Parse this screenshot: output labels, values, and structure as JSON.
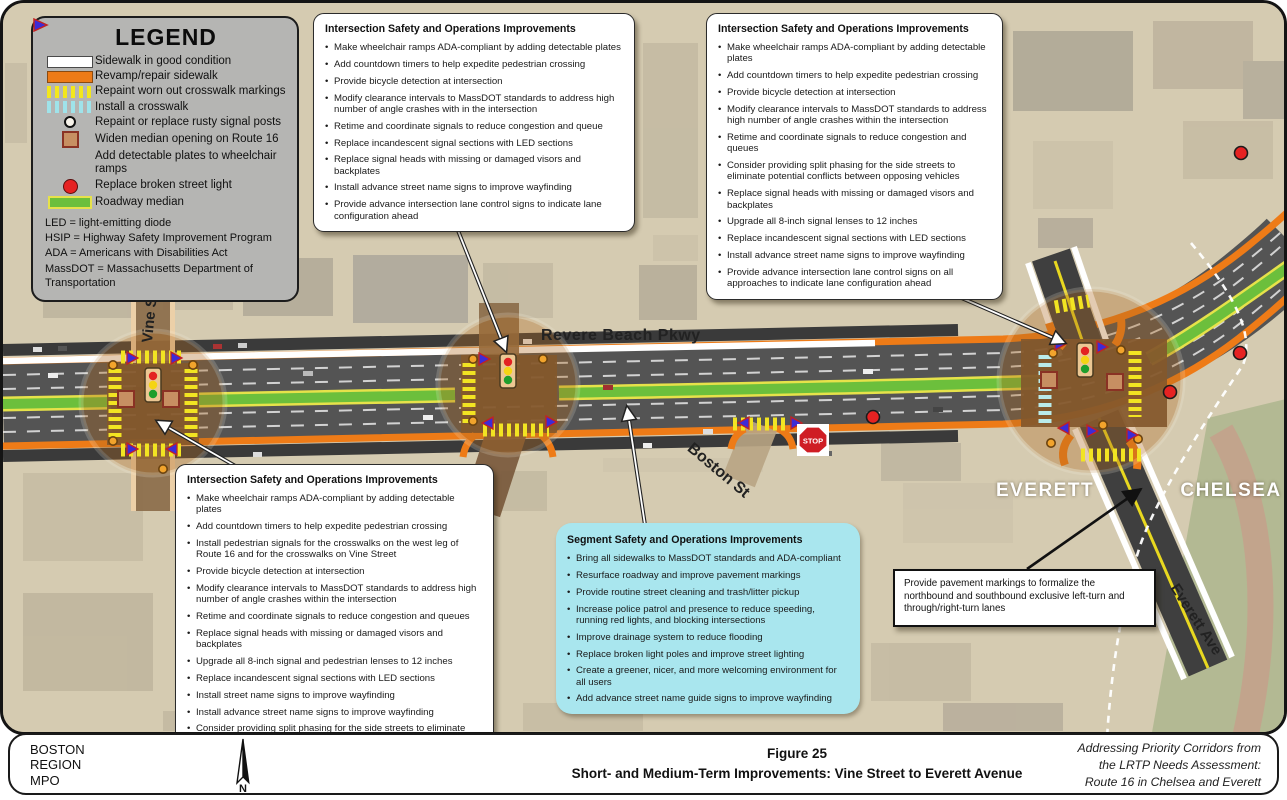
{
  "legend": {
    "title": "LEGEND",
    "items": [
      {
        "name": "sidewalk-good",
        "label": "Sidewalk in good condition"
      },
      {
        "name": "revamp-sidewalk",
        "label": "Revamp/repair sidewalk"
      },
      {
        "name": "repaint-crosswalk",
        "label": "Repaint worn out crosswalk markings"
      },
      {
        "name": "install-crosswalk",
        "label": "Install a crosswalk"
      },
      {
        "name": "rusty-signal-posts",
        "label": "Repaint or replace rusty signal posts"
      },
      {
        "name": "widen-median",
        "label": "Widen median opening on Route 16"
      },
      {
        "name": "detectable-plates",
        "label": "Add detectable plates to wheelchair ramps"
      },
      {
        "name": "broken-street-light",
        "label": "Replace broken street light"
      },
      {
        "name": "roadway-median",
        "label": "Roadway median"
      }
    ],
    "abbreviations": [
      "LED = light-emitting diode",
      "HSIP = Highway Safety Improvement Program",
      "ADA = Americans with Disabilities Act",
      "MassDOT = Massachusetts Department of Transportation"
    ]
  },
  "callouts": {
    "vale": {
      "title": "Intersection Safety and Operations Improvements",
      "bullets": [
        "Make wheelchair ramps ADA-compliant by adding detectable plates",
        "Add countdown timers to help expedite pedestrian crossing",
        "Provide bicycle detection at intersection",
        "Modify clearance intervals to MassDOT standards to address high number of angle crashes with in the intersection",
        "Retime and coordinate signals to reduce congestion and queue",
        "Replace incandescent signal sections with LED sections",
        "Replace signal heads with missing or damaged visors and backplates",
        "Install advance street name signs to improve wayfinding",
        "Provide advance intersection lane control signs to indicate lane configuration ahead"
      ]
    },
    "everett": {
      "title": "Intersection Safety and Operations Improvements",
      "bullets": [
        "Make wheelchair ramps ADA-compliant by adding detectable plates",
        "Add countdown timers to help expedite pedestrian crossing",
        "Provide bicycle detection at intersection",
        "Modify clearance intervals to MassDOT standards to address high number of angle crashes within the intersection",
        "Retime and coordinate signals to reduce congestion and queues",
        "Consider providing split phasing for the side streets to eliminate potential conflicts between opposing vehicles",
        "Replace signal heads with missing or damaged visors and backplates",
        "Upgrade all 8-inch signal lenses to 12 inches",
        "Replace incandescent signal sections with LED sections",
        "Install advance street name signs to improve wayfinding",
        "Provide advance intersection lane control signs on all approaches to indicate lane configuration ahead"
      ]
    },
    "vine": {
      "title": "Intersection Safety and Operations Improvements",
      "bullets": [
        "Make wheelchair ramps ADA-compliant by adding detectable plates",
        "Add countdown timers to help expedite pedestrian crossing",
        "Install pedestrian signals for the crosswalks on the west leg of Route 16 and for the crosswalks on Vine Street",
        "Provide bicycle detection at intersection",
        "Modify clearance intervals to MassDOT standards to address high number of angle crashes within the intersection",
        "Retime and coordinate signals to reduce congestion and queues",
        "Replace signal heads with missing or damaged visors and backplates",
        "Upgrade all 8-inch signal and pedestrian lenses to 12 inches",
        "Replace incandescent signal sections with LED sections",
        "Install street name signs to improve wayfinding",
        "Install advance street name signs to improve wayfinding",
        "Consider providing split phasing for the side streets to eliminate conflicts"
      ]
    },
    "segment": {
      "title": "Segment Safety and Operations Improvements",
      "bullets": [
        "Bring all sidewalks to MassDOT standards and ADA-compliant",
        "Resurface roadway and improve pavement markings",
        "Provide routine street cleaning and trash/litter pickup",
        "Increase police patrol and presence to reduce speeding, running red lights, and blocking intersections",
        "Improve drainage system to reduce flooding",
        "Replace broken light poles and improve street lighting",
        "Create a greener, nicer, and more welcoming environment for all users",
        "Add advance street name guide signs to improve wayfinding"
      ]
    },
    "pavement_note": {
      "text": "Provide pavement markings to formalize the northbound and southbound exclusive left-turn and through/right-turn lanes"
    }
  },
  "map_labels": {
    "corridor": "Revere Beach Pkwy",
    "vine": "Vine St",
    "vale": "Vale St",
    "boston": "Boston St",
    "everett_ave": "Everett Ave",
    "everett_city": "EVERETT",
    "chelsea_city": "CHELSEA",
    "stop": "STOP"
  },
  "footer": {
    "org_lines": [
      "BOSTON",
      "REGION",
      "MPO"
    ],
    "north": "N",
    "figure": "Figure 25",
    "title": "Short- and Medium-Term Improvements: Vine Street to Everett Avenue",
    "source_lines": [
      "Addressing Priority Corridors from",
      "the LRTP Needs Assessment:",
      "Route 16 in Chelsea and Everett"
    ]
  },
  "colors": {
    "sidewalk_good": "#ffffff",
    "revamp_sidewalk": "#ee7b17",
    "crosswalk_repaint": "#f3e71c",
    "crosswalk_install": "#9fe3ea",
    "median_green": "#6cbf3c",
    "median_edge": "#e6e24a",
    "broken_light": "#e62222",
    "detectable_plate": "#3d2bd6",
    "asphalt": "#545454",
    "highlight": "#b06a20",
    "segment_box": "#a9e6ee"
  }
}
